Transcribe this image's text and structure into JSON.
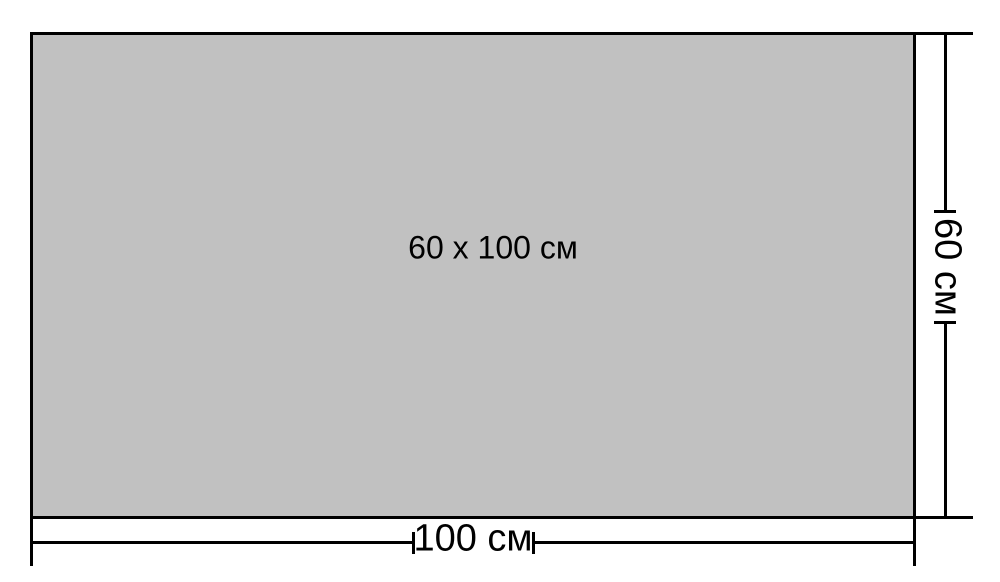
{
  "colors": {
    "rect_fill": "#c1c1c1",
    "line": "#000000",
    "background": "#ffffff",
    "text": "#000000"
  },
  "rectangle": {
    "size_label": "60 x 100 см"
  },
  "dimensions": {
    "width": {
      "label": "100 см"
    },
    "height": {
      "label": "60 см"
    }
  }
}
